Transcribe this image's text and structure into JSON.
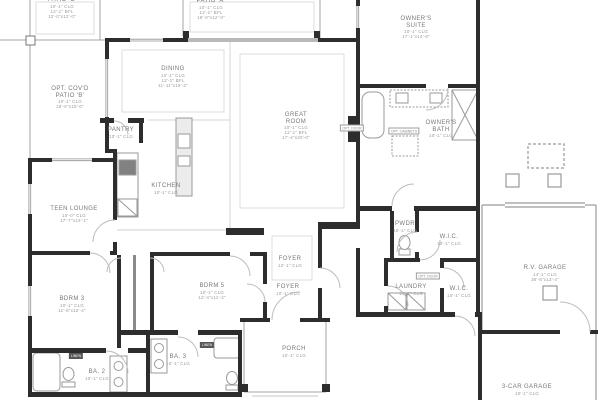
{
  "plan": {
    "type": "residential-floor-plan",
    "colors": {
      "wall": "#2d2d2d",
      "thin_line": "#a6a6a6",
      "ceiling_line": "#d6d6d6",
      "fixture": "#9a9a9a",
      "label_name": "#787878",
      "label_dim": "#9b9b9b",
      "linen_box": "#565656",
      "background": "#ffffff"
    },
    "rooms": [
      {
        "id": "patio-c",
        "name_lines": [
          "PATIO 'C'"
        ],
        "dims": [
          "10'-1\" CLG",
          "12'-1\" BFL",
          "12'-0\"x12'-0\""
        ],
        "cx": 62,
        "y": -3
      },
      {
        "id": "patio-a",
        "name_lines": [
          "PATIO 'A'"
        ],
        "dims": [
          "10'-1\" CLG",
          "12'-1\" BFL",
          "18'-0\"x12'-0\""
        ],
        "cx": 211,
        "y": -2
      },
      {
        "id": "owners-suite",
        "name_lines": [
          "OWNER'S",
          "SUITE"
        ],
        "dims": [
          "10'-1\" CLG",
          "17'-1\"x14'-8\""
        ],
        "cx": 416,
        "y": 16
      },
      {
        "id": "dining",
        "name_lines": [
          "DINING"
        ],
        "dims": [
          "10'-1\" CLG",
          "12'-1\" BFL",
          "11'-11\"x15'-2\""
        ],
        "cx": 173,
        "y": 66
      },
      {
        "id": "great-room",
        "name_lines": [
          "GREAT",
          "ROOM"
        ],
        "dims": [
          "10'-1\" CLG",
          "12'-1\" BFL",
          "17'-4\"x20'-0\""
        ],
        "cx": 296,
        "y": 112
      },
      {
        "id": "opt-covd-patio-b",
        "name_lines": [
          "OPT. COV'D",
          "PATIO 'B'"
        ],
        "dims": [
          "10'-1\" CLG",
          "18'-0\"x10'-0\""
        ],
        "cx": 70,
        "y": 86
      },
      {
        "id": "pantry",
        "name_lines": [
          "PANTRY"
        ],
        "dims": [
          "10'-1\" CLG"
        ],
        "cx": 121,
        "y": 127
      },
      {
        "id": "kitchen",
        "name_lines": [
          "KITCHEN"
        ],
        "dims": [
          "10'-1\" CLG"
        ],
        "cx": 166,
        "y": 183
      },
      {
        "id": "teen-lounge",
        "name_lines": [
          "TEEN LOUNGE"
        ],
        "dims": [
          "10'-0\" CLG",
          "17'-7\"x13'-1\""
        ],
        "cx": 74,
        "y": 206
      },
      {
        "id": "bdrm-3",
        "name_lines": [
          "BDRM 3"
        ],
        "dims": [
          "10'-1\" CLG",
          "11'-5\"x12'-4\""
        ],
        "cx": 72,
        "y": 296
      },
      {
        "id": "bdrm-5",
        "name_lines": [
          "BDRM 5"
        ],
        "dims": [
          "10'-1\" CLG",
          "12'-4\"x11'-2\""
        ],
        "cx": 212,
        "y": 283
      },
      {
        "id": "foyer-upper",
        "name_lines": [
          "FOYER"
        ],
        "dims": [
          "12'-1\" CLG"
        ],
        "cx": 290,
        "y": 256
      },
      {
        "id": "foyer-lower",
        "name_lines": [
          "FOYER"
        ],
        "dims": [
          "10'-1\" CLG"
        ],
        "cx": 288,
        "y": 284
      },
      {
        "id": "porch",
        "name_lines": [
          "PORCH"
        ],
        "dims": [
          "10'-1\" CLG"
        ],
        "cx": 294,
        "y": 346
      },
      {
        "id": "owners-bath",
        "name_lines": [
          "OWNER'S",
          "BATH"
        ],
        "dims": [
          "10'-1\" CLG"
        ],
        "cx": 441,
        "y": 120
      },
      {
        "id": "pwdr",
        "name_lines": [
          "PWDR"
        ],
        "dims": [
          "10'-1\" CLG"
        ],
        "cx": 405,
        "y": 221
      },
      {
        "id": "wic-upper",
        "name_lines": [
          "W.I.C."
        ],
        "dims": [
          "10'-1\" CLG"
        ],
        "cx": 449,
        "y": 234
      },
      {
        "id": "laundry",
        "name_lines": [
          "LAUNDRY"
        ],
        "dims": [
          "10'-1\" CLG"
        ],
        "cx": 411,
        "y": 284
      },
      {
        "id": "wic-lower",
        "name_lines": [
          "W.I.C."
        ],
        "dims": [
          "10'-1\" CLG"
        ],
        "cx": 459,
        "y": 286
      },
      {
        "id": "ba-2",
        "name_lines": [
          "BA. 2"
        ],
        "dims": [
          "10'-1\" CLG"
        ],
        "cx": 97,
        "y": 369
      },
      {
        "id": "ba-3",
        "name_lines": [
          "BA. 3"
        ],
        "dims": [
          "10'-1\" CLG"
        ],
        "cx": 178,
        "y": 354
      },
      {
        "id": "rv-garage",
        "name_lines": [
          "R.V. GARAGE"
        ],
        "dims": [
          "14'-1\" CLG",
          "36'-8\"x13'-4\""
        ],
        "cx": 545,
        "y": 265
      },
      {
        "id": "3-car-garage",
        "name_lines": [
          "3-CAR GARAGE"
        ],
        "dims": [
          "10'-1\" CLG"
        ],
        "cx": 527,
        "y": 384
      }
    ],
    "tags": [
      {
        "id": "linen-1",
        "label": "LINEN",
        "style": "tag-linen",
        "cx": 76,
        "cy": 356
      },
      {
        "id": "linen-2",
        "label": "LINEN",
        "style": "tag-linen",
        "cx": 207,
        "cy": 345
      },
      {
        "id": "opt-cabinets",
        "label": "OPT. CABINETS",
        "style": "tag-box",
        "cx": 404,
        "cy": 131
      },
      {
        "id": "opt-door-laundry",
        "label": "OPT. DOOR",
        "style": "tag-box",
        "cx": 428,
        "cy": 276
      },
      {
        "id": "opt-door-great-room",
        "label": "OPT. DOOR",
        "style": "tag-box",
        "cx": 352,
        "cy": 128
      }
    ]
  }
}
